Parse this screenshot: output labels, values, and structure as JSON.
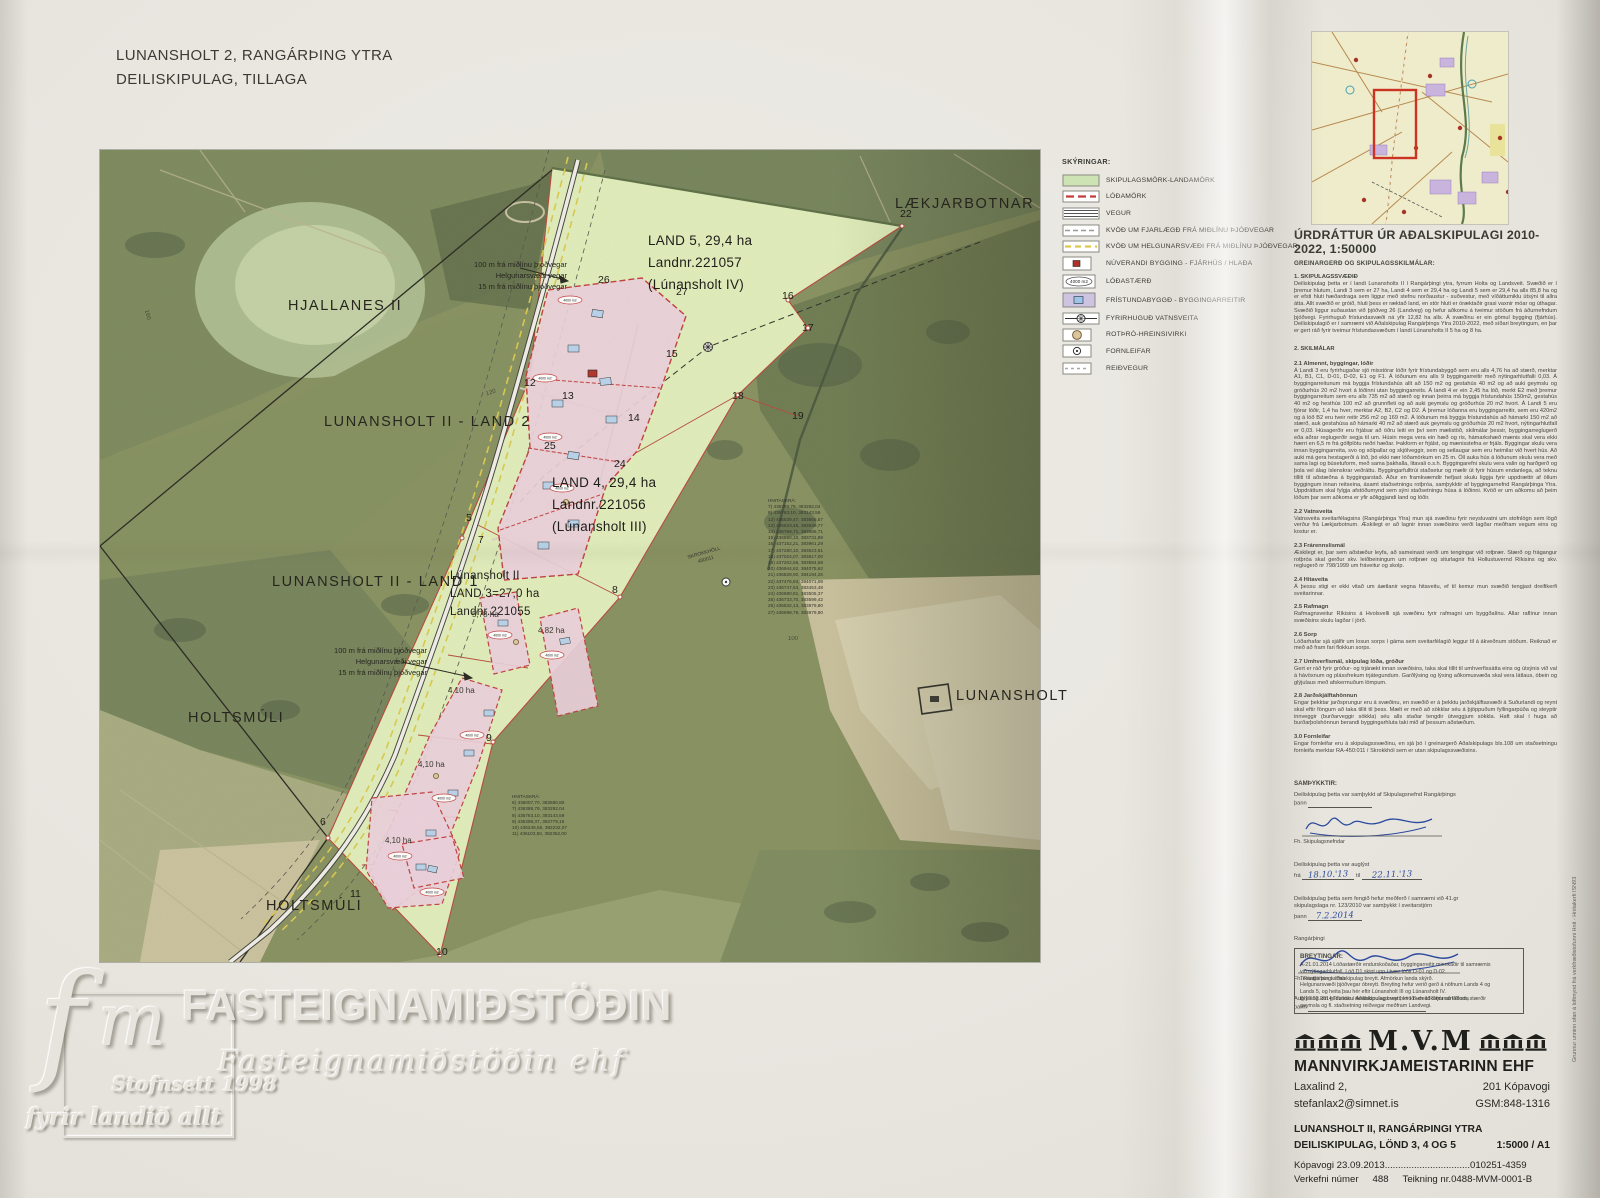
{
  "doc_title": {
    "line1": "LUNANSHOLT 2,  RANGÁRÞING YTRA",
    "line2": "DEILISKIPULAG,  TILLAGA"
  },
  "legend": {
    "heading": "SKÝRINGAR:",
    "items": [
      "SKIPULAGSMÖRK-LANDAMÖRK",
      "LÓÐAMÖRK",
      "VEGUR",
      "KVÖÐ UM FJARLÆGÐ FRÁ MIÐLÍNU ÞJÓÐVEGAR",
      "KVÖÐ UM HELGUNARSVÆÐI FRÁ MIÐLÍNU ÞJÓÐVEGAR",
      "NÚVERANDI BYGGING - FJÁRHÚS / HLAÐA",
      "LÓÐASTÆRÐ",
      "FRÍSTUNDABYGGÐ - BYGGINGARREITIR",
      "FYRIRHUGUÐ VATNSVEITA",
      "ROTÞRÓ-HREINSIVIRKI",
      "FORNLEIFAR",
      "REIÐVEGUR"
    ],
    "lot_size_icon_label": "4000 m2"
  },
  "map": {
    "place_labels": {
      "laekjarbotnar": "LÆKJARBOTNAR",
      "hjallanes": "HJALLANES II",
      "land2": "LUNANSHOLT II - LAND 2",
      "land1": "LUNANSHOLT II - LAND 1",
      "holtsmuli1": "HOLTSMÚLI",
      "holtsmuli2": "HOLTSMÚLI",
      "lunansholt": "LUNANSHOLT"
    },
    "land5": "LAND 5,  29,4 ha\nLandnr.221057\n(Lúnansholt IV)",
    "land4": "LAND 4,  29,4 ha\nLandnr.221056\n(Lúnansholt III)",
    "land3": "Lúnansholt II\nLAND 3=27,0 ha\nLandnr.221055",
    "road_note_top": "100 m frá miðlínu þjóðvegar\nHelgunarsvæði vegar\n15 m frá miðlínu þjóðvegar",
    "road_note_mid": "100 m frá miðlínu þjóðvegar\nHelgunarsvæði vegar\n15 m frá miðlínu þjóðvegar",
    "areas": [
      "5,78 ha",
      "4,82 ha",
      "4,10 ha",
      "4,10 ha",
      "4,10 ha"
    ],
    "points": [
      "22",
      "26",
      "27",
      "16",
      "17",
      "15",
      "12",
      "13",
      "14",
      "18",
      "19",
      "25",
      "24",
      "5",
      "7",
      "8",
      "9",
      "6",
      "11",
      "10"
    ],
    "contours": [
      "160",
      "120",
      "100"
    ],
    "lot_size_label": "4000 m2",
    "fornleifar": "SKROKKHÓLL\n450011",
    "hnitaskra_main": "HNITASKRÁ:\n7) 436389,79, 383292,04\n8) 436763,10, 383143,59\n12) 436539,47, 383865,57\n13) 436623,45, 383639,77\n14) 436769,71, 383585,71\n15) 436890,10, 383731,89\n16) 437152,21, 383961,29\n17) 437280,10, 383623,61\n18) 437024,07, 383817,00\n19) 437202,55, 383584,58\n20) 436944,62, 384075,62\n21) 436828,90, 384194,26\n22) 437476,83, 384071,08\n23) 436747,63, 383453,48\n24) 436580,81, 383506,37\n25) 436733,70, 383599,42\n26) 436532,13, 383879,80\n27) 436698,79, 383979,80",
    "hnitaskra_south": "HNITASKRÁ:\n6) 436007,70, 382580,80\n7) 436389,79, 383292,04\n8) 436763,10, 383143,59\n9) 436398,37, 382779,15\n10) 436246,65, 382232,07\n11) 436103,50, 382352,00"
  },
  "report": {
    "title": "ÚRDRÁTTUR ÚR AÐALSKIPULAGI 2010-2022, 1:50000",
    "subtitle": "GREINARGERÐ OG SKIPULAGSSKILMÁLAR:",
    "sections": [
      {
        "heading": "1.   SKIPULAGSSVÆÐIÐ",
        "body": "Deiliskipulag þetta er í landi Lunansholts II í Rangárþingi ytra, fyrrum Holta og Landsveit. Svæðið er í þremur hlutum, Landi 3 sem er 27 ha, Landi 4 sem er 29,4 ha og Landi 5 sem er 29,4 ha  alls 85,8 ha  og er efsti hluti hæðardraga sem liggur með stefnu norðaustur - suðvestur,  með víðáttumiklu útsýni til allra átta. Allt svæðið er gróið, hluti þess er ræktað land, en stór hluti er óræktaðir grasi vaxnir móar og úthagar. Svæðið liggur suðaustan við þjóðveg 26 (Landveg) og hefur aðkomu á tveimur stöðum frá áðurnefndum þjóðvegi. Fyrirhuguð frístundasvæði ná yfir 12,82 ha alls. Á svæðinu er ein gömul bygging (fjárhús). Deiliskipulagið er í samræmi við Aðalskipulag Rangárþings Ytra 2010-2022, með síðari breytingum, en þar er gert ráð fyrir tveimur frístundasvæðum í landi Lúnansholts II 5 ha og 8 ha."
      },
      {
        "heading": "2. SKILMÁLAR",
        "body": ""
      },
      {
        "heading": "2.1 Almennt, byggingar, lóðir",
        "body": "Á Landi 3 eru fyrirhugaðar sjö misstórar lóðir fyrir frístundabyggð sem eru alls 4,76 ha að stærð, merktar A1, B1, C1, D-01, D-02, E1 og F1.  Á lóðunum eru alls 9 byggingarreitir með nýtingarhlutfalli 0,03.  Á byggingarreitunum má byggja frístundahús allt að 150 m2  og gestahús 40 m2  og að auki geymslu og gróðurhús 20 m2 hvort á lóðinni utan byggingarreits.  Á landi 4 er ein 2,45 ha lóð, merkt E2 með þremur byggingarreitum sem eru alls 735 m2 að stærð og innan þeirra má byggja frístundahús 150m2, gestahús 40 m2 og hesthús 100 m2 að grunnfleti og að auki geymslu og gróðurhús 20 m2 hvort.  Á Landi 5 eru fjórar lóðir, 1,4 ha hver, merktar A2, B2, C2 og D2.  Á þremur lóðanna eru byggingarreitir, sem eru 420m2 og á lóð B2 eru tveir reitir 256 m2 og 169 m2.  Á lóðunum má byggja frístundahús að hámarki 150 m2 að stærð, auk gestahúsa að hámarki 40 m2 að stærð auk geymslu og gróðurhús 20 m2 hvort, nýtingarhlutfall er 0,03.  Húsagerðir eru frjálsar að öðru leiti en því sem mælistöð, skilmálar þessir, byggingarreglugerð eða aðrar reglugerðir segja til um.  Húsin mega vera ein hæð og ris, hámarkshæð mænis skal vera ekki hærri en 6,5 m frá gólfplötu neðri hæðar. Þakform er frjálst, og mænisstefna er frjáls. Byggingar skulu vera innan byggingarreita, svo og sólpallar og skjólveggir, sem og setlaugar sem eru heimilar við hvert hús.  Að auki má gera hestagerði á lóð, þó ekki nær lóðamörkum en 25 m. Öll auka hús á lóðunum skulu vera með sama lagi og búsetuform, með sama þakhalla, litavali o.s.h.  Byggingarefni skulu vera valin og harðgerð og þola vel álag íslenskrar veðráttu. Byggingarfulltrúi staðsetur og mælir út fyrir húsum endanlega, að teknu tilliti til aðstæðna á byggingarstað. Áður en framkvæmdir hefjast skulu liggja fyrir uppdrættir af öllum byggingum innan reitseina, ásamt staðsetningu rotþróa, samþykktir af byggingarnefnd Rangárþinga Ytra. Uppdráttum skal fylgja afstöðumynd sem sýni staðsetningu húsa á lóðinni.  Kvöð er um aðkomu að þeim lóðum þar sem aðkoma er yfir aðliggjandi land og lóðir."
      },
      {
        "heading": "2.2 Vatnsveita",
        "body": "Vatnsveita sveitarfélagsins (Rangárþinga Ytra)  mun sjá svæðinu fyrir neysluvatni um stofnlögn sem lögð verður frá Lækjarbotnum.  Æskilegt er að lagnir innan svæðisins verði lagðar meðfram vegum eins og kostur er."
      },
      {
        "heading": "2.3 Frárennslismál",
        "body": "Æskilegt er, þar sem aðstæður leyfa,  að sameinast verði um tengingar við rotþrær. Stærð og frágangur rotþróa skal gerður skv. leiðbeiningum um rotþrær og siturlagnir frá Hollustuvernd Ríkisins og skv. reglugerð nr 798/1999 um fráveitur og skolp."
      },
      {
        "heading": "2.4 Hitaveita",
        "body": "Á þessu stigi er ekki vitað um áætlanir vegna hitaveitu, ef til kemur mun svæðið tengjast dreifikerfi sveitarinnar."
      },
      {
        "heading": "2.5 Rafmagn",
        "body": "Rafmagnsveitur Ríkisins á Hvolsvelli sjá svæðinu fyrir rafmagni um byggðalínu. Allar raflínur innan svæðisins skulu lagðar í jörð."
      },
      {
        "heading": "2.6 Sorp",
        "body": "Lóðarhafar sjá sjálfir um losun sorps í gáma sem sveitarfélagið leggur til á ákveðnum stöðum. Reiknað er með að fram fari flokkun sorps."
      },
      {
        "heading": "2.7 Umhverfismál, skipulag lóða, gróður",
        "body": "Gert er ráð fyrir gróður- og trjárækt innan svæðisins, taka skal tillit til umhverfissátta eins og útsýnis við val á hávöxnum og plássfrekum trjátegundum. Garðlýsing og lýsing aðkomusvæða skal vera látlaus, óbein og glýjulaus með afskermuðum lömpum."
      },
      {
        "heading": "2.8 Jarðskjálftahönnun",
        "body": "Engar þekktar jarðsprungur eru á svæðinu, en svæðið er á þekktu jarðskjálftasvæði á Suðurlandi og reynt skal eftir föngum að taka tillit til þess. Mælt er með að sökklar séu á þjöppuðum fyllingarpúða og steyptir innveggir (burðarveggir sökkla) séu alls staðar tengdir útveggjum sökkla. Haft skal í huga að burðarþolshönnun berandi byggingarhluta taki mið af þessum aðstæðum."
      },
      {
        "heading": "3.0 Fornleifar",
        "body": "Engar fornleifar eru á skipulagssvæðinu, en sjá þó í greinargerð Aðalskipulags bls.108 um staðsetningu fornleifa merktar RA-450:011 í Skrokkhól sem er utan skipulagssvæðisins."
      }
    ],
    "samthykktir": {
      "heading": "SAMÞYKKTIR:",
      "line1": "Deiliskipulag þetta var samþykkt af Skipulagsnefnd Rangárþings",
      "thann": "þann",
      "sig1_caption": "Fh. Skipulagsnefndar",
      "line2": "Deiliskipulag þetta var  auglýst",
      "fra": "frá",
      "date_fra": "18.10.'13",
      "til": "til",
      "date_til": "22.11.'13",
      "line3a": "Deiliskipulag þetta sem fengið hefur meðferð í samræmi við 41.gr",
      "line3b": "skipulagslaga nr. 123/2010 var samþykkt í sveitarstjórn",
      "date3": "7.2.2014",
      "line4": "Rangárþingi",
      "sig2_caption": "Fh. Rangárþings Ytra",
      "line5": "Auglýsing um gildistöku deiliskipulags var birt í B-deild Stjórnartíðinda"
    },
    "breytingar": {
      "heading": "BREYTINGAR:",
      "body": "A-21.01.2014  Lóðastærðir endurskoðaðar, byggingarreitir minnkaðir til samræmis\nvið nýtingarhlutfall.  Lóð D1 skipt upp í tvær lóðir D-01 og D-02.\nTextatilvísun í aðalskipulag breytt. Afmörkun landa skýrð.\nHelgunarsvæði þjóðvegar óbreytt.  Breyting hefur verið gerð á nöfnum Lands 4 og\nLands 5, og heita þau hér eftir Lúnansholt III og Lúnansholt IV.\nB-10.02.2014  Tilvísun í Aðalskipulag breytt, kvöð um aðkomu að lóðum, stærðir\ngeymsla og fl. staðsetning reiðvegar meðfram Landvegi."
    }
  },
  "titleblock": {
    "logo": "M.V.M",
    "company": "MANNVIRKJAMEISTARINN EHF",
    "address": "Laxalind 2,",
    "city": "201 Kópavogi",
    "email": "stefanlax2@simnet.is",
    "phone": "GSM:848-1316",
    "project1": "LUNANSHOLT  II,  RANGÁRÞINGI YTRA",
    "project2": "DEILISKIPULAG, LÖND 3, 4 OG 5",
    "scale": "1:5000 / A1",
    "date_left": "Kópavogi 23.09.2013",
    "date_dots": "................................",
    "date_right": "010251-4359",
    "verkefni_label": "Verkefni númer",
    "verkefni_no": "488",
    "teikning": "Teikning nr.0488-MVM-0001-B"
  },
  "watermark": {
    "logo_f": "f",
    "logo_m": "m",
    "big": "FASTEIGNAMIÐSTÖÐIN",
    "script": "Fasteignamiðstöðin ehf",
    "line1": "Stofnsett 1998",
    "line2": "fyrir landið allt"
  },
  "side_note": "Grunnur unninn ofan á loftmynd frá verkfræðistofunni Hnit - Hnitakerfi ISN93"
}
